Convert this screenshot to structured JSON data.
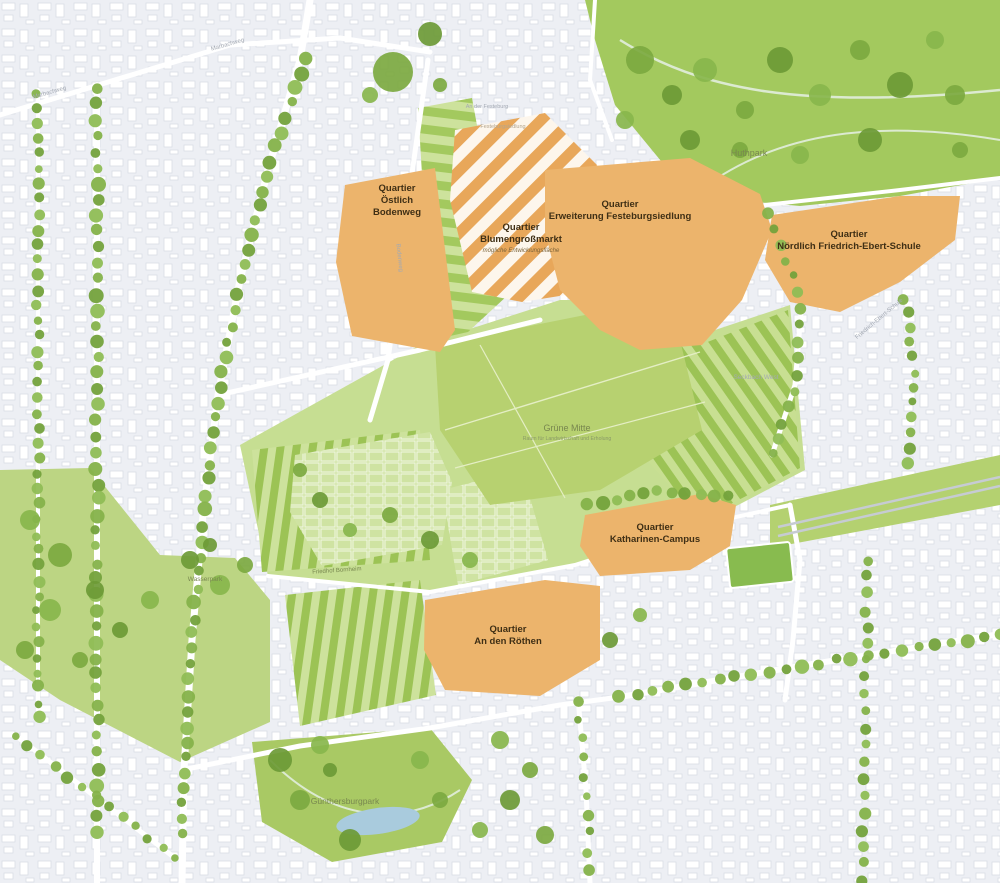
{
  "map": {
    "title": "Stadtplanungs-Rahmenplan Quartiere",
    "quarters": [
      {
        "id": "oestlich-bodenweg",
        "lines": [
          "Quartier",
          "Östlich",
          "Bodenweg"
        ]
      },
      {
        "id": "blumengrossmarkt",
        "lines": [
          "Quartier",
          "Blumengroßmarkt"
        ],
        "subtitle": "mögliche Entwicklungsfläche"
      },
      {
        "id": "erweiterung-festeburgsiedlung",
        "lines": [
          "Quartier",
          "Erweiterung Festeburgsiedlung"
        ]
      },
      {
        "id": "noerdlich-friedrich-ebert-schule",
        "lines": [
          "Quartier",
          "Nördlich Friedrich-Ebert-Schule"
        ]
      },
      {
        "id": "katharinen-campus",
        "lines": [
          "Quartier",
          "Katharinen-Campus"
        ]
      },
      {
        "id": "an-den-roethen",
        "lines": [
          "Quartier",
          "An den Röthen"
        ]
      }
    ],
    "places": {
      "huthpark": "Huthpark",
      "gruene_mitte": "Grüne Mitte",
      "gruene_mitte_subtitle": "Raum für Landwirtschaft und Erholung",
      "wasserpark": "Wasserpark",
      "friedhof_bornheim": "Friedhof Bornheim",
      "guenthersburgpark": "Günthersburgpark",
      "friedrich_ebert_schule": "Friedrich-Ebert-Schule",
      "seckbach_west": "Seckbach West",
      "marbachweg": "Marbachweg",
      "an_der_festeburg": "An der Festeburg",
      "festeburgsiedlung": "Festeburgsiedlung",
      "bodenweg": "Bodenweg"
    },
    "colors": {
      "urban_bg": "#edeff4",
      "building": "#ffffff",
      "building_stroke": "#d9dde5",
      "quarter_orange": "#ecb46c",
      "hatch_orange": "#e8a75a",
      "hatch_bg": "#fdf6ec",
      "park_green": "#a3c95e",
      "meadow_green": "#b7d170",
      "band_green": "#c6de92",
      "strip_dark": "#9cc355",
      "strip_light": "#cde29c",
      "tree_green": "#7cab41",
      "water_blue": "#a9cbdd",
      "quarter_label": "#3f2f15",
      "park_label": "#78874f",
      "street_label": "#a3a9b3"
    }
  }
}
